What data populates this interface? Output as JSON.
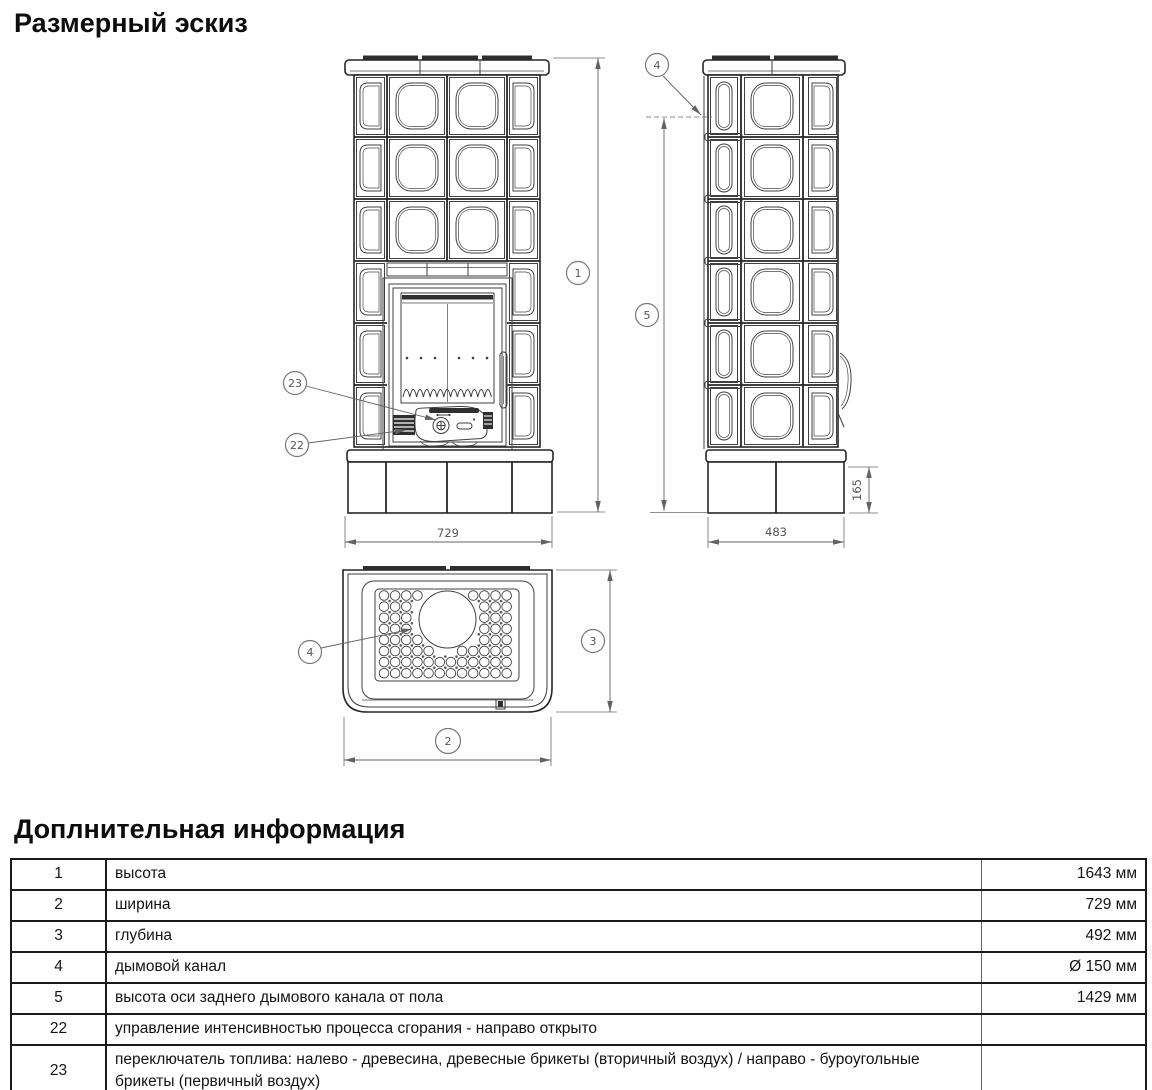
{
  "title": "Размерный эскиз",
  "sketch": {
    "callouts": {
      "c1": "1",
      "c2": "2",
      "c3": "3",
      "c4": "4",
      "c5": "5",
      "c22": "22",
      "c23": "23"
    },
    "dims": {
      "width_front": "729",
      "depth_side": "483",
      "base_height": "165"
    }
  },
  "info": {
    "title": "Доплнительная информация",
    "rows": [
      {
        "num": "1",
        "desc": "высота",
        "value": "1643 мм"
      },
      {
        "num": "2",
        "desc": "ширина",
        "value": "729 мм"
      },
      {
        "num": "3",
        "desc": "глубина",
        "value": "492 мм"
      },
      {
        "num": "4",
        "desc": "дымовой канал",
        "value": "Ø 150 мм"
      },
      {
        "num": "5",
        "desc": "высота оси заднего дымового канала от пола",
        "value": "1429 мм"
      },
      {
        "num": "22",
        "desc": "управление интенсивностью процесса сгорания - направо открыто",
        "value": ""
      },
      {
        "num": "23",
        "desc": "переключатель топлива: налево - древесина, древесные брикеты (вторичный воздух) / направо - буроугольные брикеты (первичный воздух)",
        "value": ""
      }
    ]
  },
  "colors": {
    "line": "#3f3f3f",
    "dim": "#5f6368",
    "text": "#111111"
  }
}
